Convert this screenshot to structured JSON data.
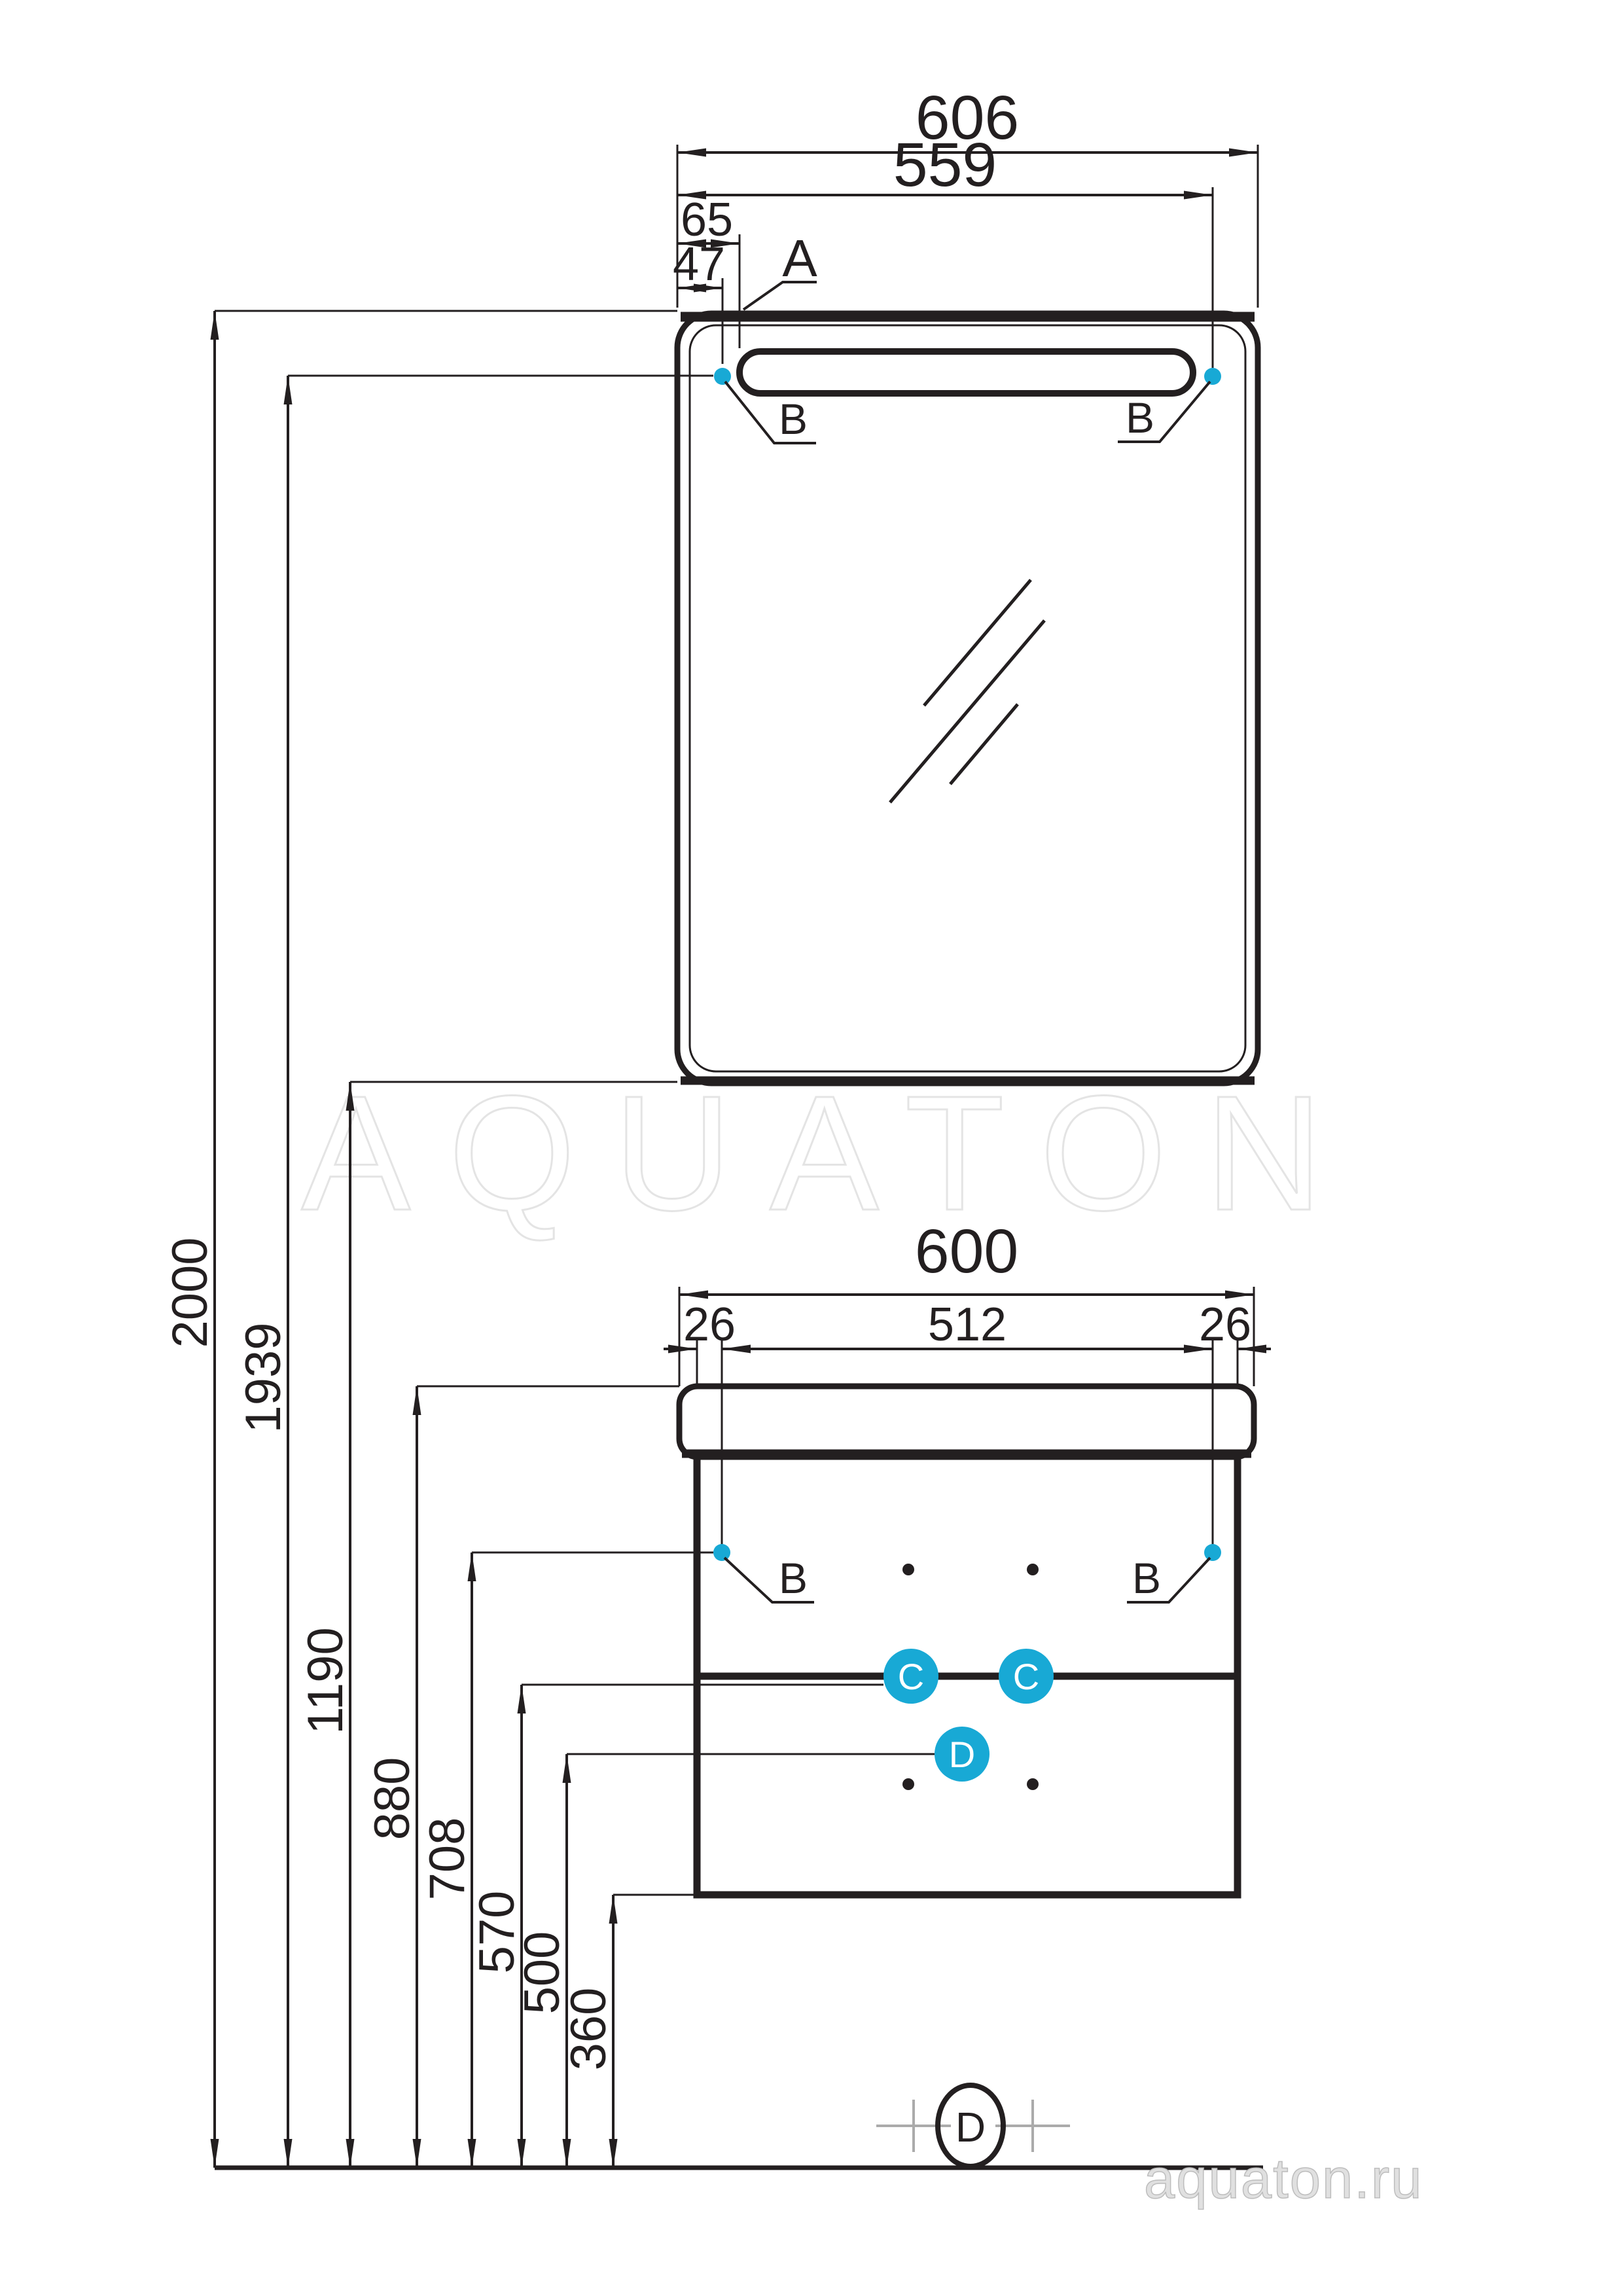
{
  "watermark": "AQUATON",
  "website": "aquaton.ru",
  "colors": {
    "accent": "#18a9d5",
    "line": "#231f20",
    "watermark_stroke": "#e4e4e4",
    "website_gray": "#bdbdbd"
  },
  "mirror": {
    "width": "606",
    "hole_span": "559",
    "lamp_offset": "65",
    "hole_offset": "47",
    "label_a": "A",
    "label_b_left": "B",
    "label_b_right": "B"
  },
  "cabinet": {
    "width": "600",
    "side_left": "26",
    "hole_span": "512",
    "side_right": "26",
    "label_b_left": "B",
    "label_b_right": "B",
    "label_c_left": "C",
    "label_c_right": "C",
    "label_d": "D"
  },
  "heights": [
    "2000",
    "1939",
    "1190",
    "880",
    "708",
    "570",
    "500",
    "360"
  ],
  "floor_label": "D"
}
